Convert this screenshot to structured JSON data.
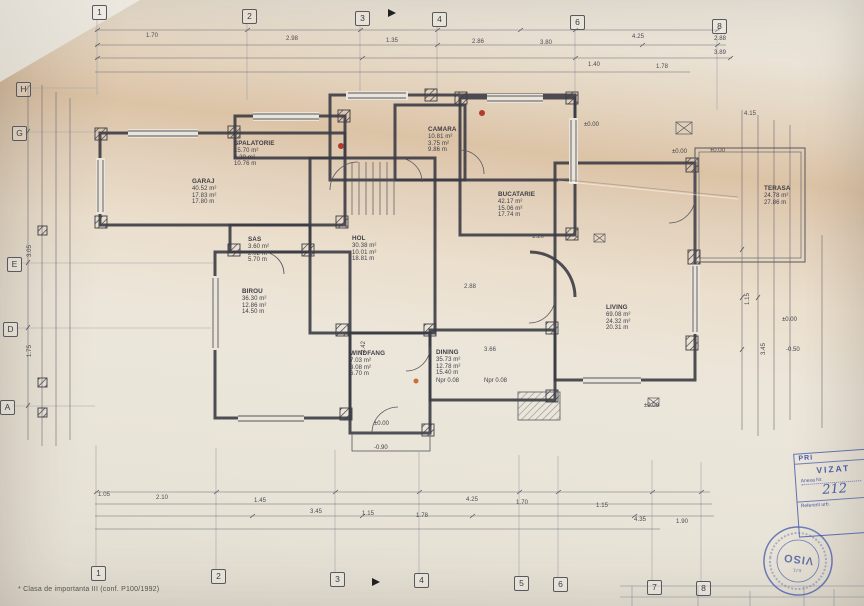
{
  "note": "* Clasa de importanta  III (conf. P100/1992)",
  "grid": {
    "top": [
      "1",
      "2",
      "3",
      "4",
      "6",
      "8"
    ],
    "bottom": [
      "1",
      "2",
      "3",
      "4",
      "5",
      "6",
      "7",
      "8"
    ],
    "left": [
      "H",
      "G",
      "E",
      "D",
      "A"
    ]
  },
  "rooms": {
    "spalatorie": {
      "name": "SPALATORIE",
      "a1": "15.70 m²",
      "a2": "6.30 m²",
      "a3": "10.76 m"
    },
    "garaj": {
      "name": "GARAJ",
      "a1": "40.52 m²",
      "a2": "17.83 m²",
      "a3": "17.80 m"
    },
    "camara": {
      "name": "CAMARA",
      "a1": "10.81 m²",
      "a2": "3.75 m²",
      "a3": "9.86 m"
    },
    "bucatarie": {
      "name": "BUCATARIE",
      "a1": "42.17 m²",
      "a2": "15.06 m²",
      "a3": "17.74 m"
    },
    "hol": {
      "name": "HOL",
      "a1": "30.38 m²",
      "a2": "10.01 m²",
      "a3": "18.81 m"
    },
    "sas": {
      "name": "SAS",
      "a1": "3.60 m²",
      "a2": "2.02 m²",
      "a3": "5.70 m"
    },
    "birou": {
      "name": "BIROU",
      "a1": "36.30 m²",
      "a2": "12.86 m²",
      "a3": "14.50 m"
    },
    "windfang": {
      "name": "WINDFANG",
      "a1": "7.03 m²",
      "a2": "3.08 m²",
      "a3": "6.70 m"
    },
    "dining": {
      "name": "DINING",
      "a1": "35.73 m²",
      "a2": "12.78 m²",
      "a3": "15.40 m"
    },
    "living": {
      "name": "LIVING",
      "a1": "69.08 m²",
      "a2": "24.32 m²",
      "a3": "20.31 m"
    },
    "terasa": {
      "name": "TERASA",
      "a1": "24.78 m²",
      "a2": "27.86 m"
    }
  },
  "dims": [
    "1.70",
    "2.98",
    "1.35",
    "2.86",
    "3.80",
    "4.25",
    "2.88",
    "3.89",
    "4.15",
    "1.40",
    "1.78",
    "1.05",
    "2.10",
    "1.45",
    "3.45",
    "1.15",
    "1.78",
    "4.25",
    "1.70",
    "1.15",
    "4.35",
    "1.90",
    "2.88",
    "3.66",
    "2.42",
    "1.20",
    "3.05",
    "1.75",
    "1.15",
    "3.45"
  ],
  "levels": [
    "±0.00",
    "±0.00",
    "±0.00",
    "±0.00",
    "±0.00",
    "-0.90",
    "±0.00",
    "-0.50",
    "Npr 0.08",
    "Npr 0.08"
  ],
  "stamp": {
    "header": "PRI",
    "title": "VIZAT",
    "anexa": "Anexa Nr.",
    "number": "212",
    "footer": "Referent urb."
  },
  "seal": {
    "name": "VISO",
    "sub": "s.r.l."
  },
  "colors": {
    "ink": "#3c3c45",
    "thin": "#565660",
    "stamp_blue": "#4053a4",
    "dot_red": "#b03a2e",
    "dot_orange": "#c87137"
  }
}
